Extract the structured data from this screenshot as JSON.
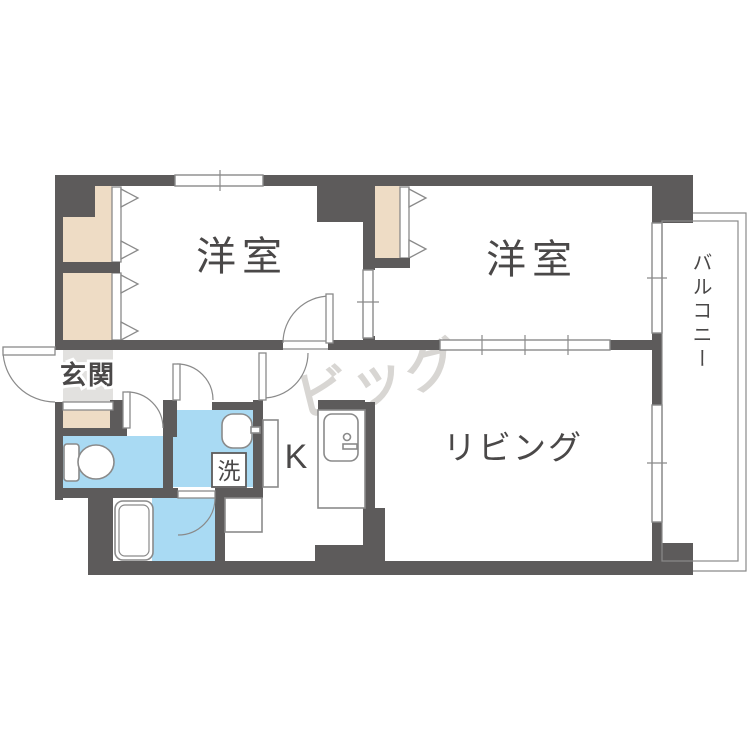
{
  "plan": {
    "type": "apartment-floorplan",
    "watermark": "ビッグ",
    "rooms": {
      "bedroom1": {
        "label": "洋室"
      },
      "bedroom2": {
        "label": "洋室"
      },
      "living": {
        "label": "リビング"
      },
      "kitchen": {
        "label": "K"
      },
      "entrance": {
        "label": "玄関"
      },
      "washer": {
        "label": "洗"
      },
      "balcony": {
        "label": "バルコニー"
      }
    },
    "colors": {
      "wall": "#5d5b5b",
      "water_room": "#a9daf3",
      "closet": "#eedcc5",
      "entrance_floor": "#e2e1df",
      "line": "#8a8a8a",
      "label_text": "#4a4848",
      "watermark": "#d8d6d3"
    },
    "fixtures": [
      "toilet",
      "bathtub",
      "wash-basin",
      "kitchen-sink",
      "washing-machine",
      "bathtub",
      "shoe-cabinet"
    ]
  }
}
